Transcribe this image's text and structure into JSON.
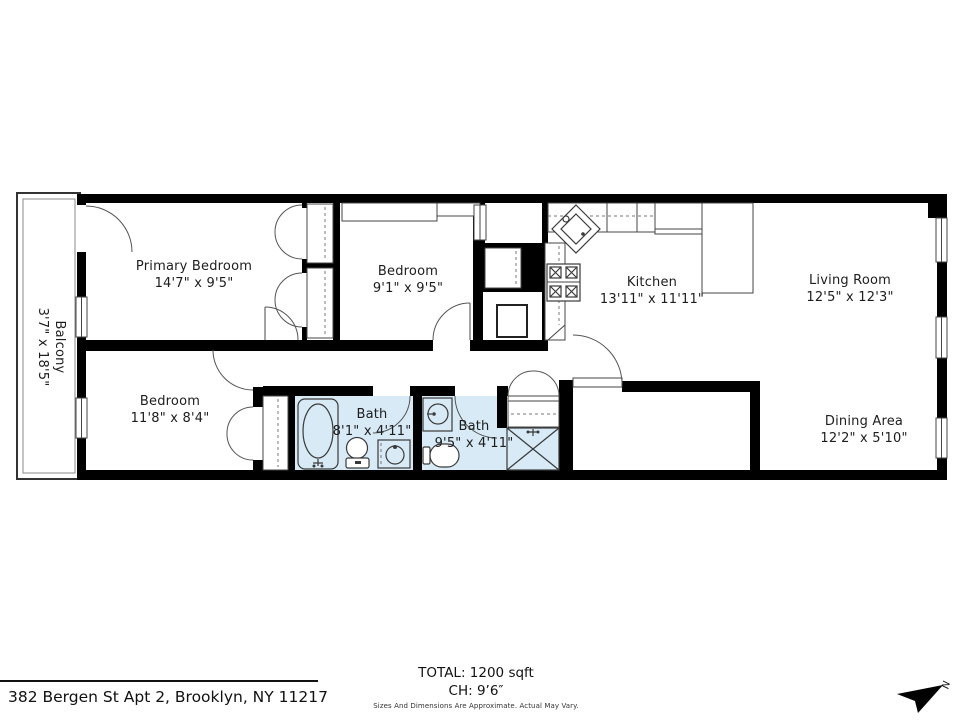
{
  "floorplan": {
    "rooms": {
      "primary_bedroom": {
        "name": "Primary Bedroom",
        "dims": "14'7\" x 9'5\""
      },
      "bedroom_2": {
        "name": "Bedroom",
        "dims": "9'1\" x 9'5\""
      },
      "bedroom_3": {
        "name": "Bedroom",
        "dims": "11'8\" x 8'4\""
      },
      "kitchen": {
        "name": "Kitchen",
        "dims": "13'11\" x 11'11\""
      },
      "living_room": {
        "name": "Living Room",
        "dims": "12'5\" x 12'3\""
      },
      "dining_area": {
        "name": "Dining Area",
        "dims": "12'2\" x 5'10\""
      },
      "bath_1": {
        "name": "Bath",
        "dims": "8'1\" x 4'11\""
      },
      "bath_2": {
        "name": "Bath",
        "dims": "9'5\" x 4'11\""
      },
      "balcony": {
        "name": "Balcony",
        "dims": "3'7\" x 18'5\""
      }
    },
    "colors": {
      "wall": "#000000",
      "bath_fill": "#d7eaf6",
      "line": "#444444"
    }
  },
  "footer": {
    "address": "382 Bergen St Apt 2, Brooklyn, NY 11217",
    "total": "TOTAL: 1200 sqft",
    "ceiling_height": "CH: 9’6″",
    "disclaimer": "Sizes And Dimensions Are Approximate. Actual May Vary.",
    "north_label": "N"
  }
}
